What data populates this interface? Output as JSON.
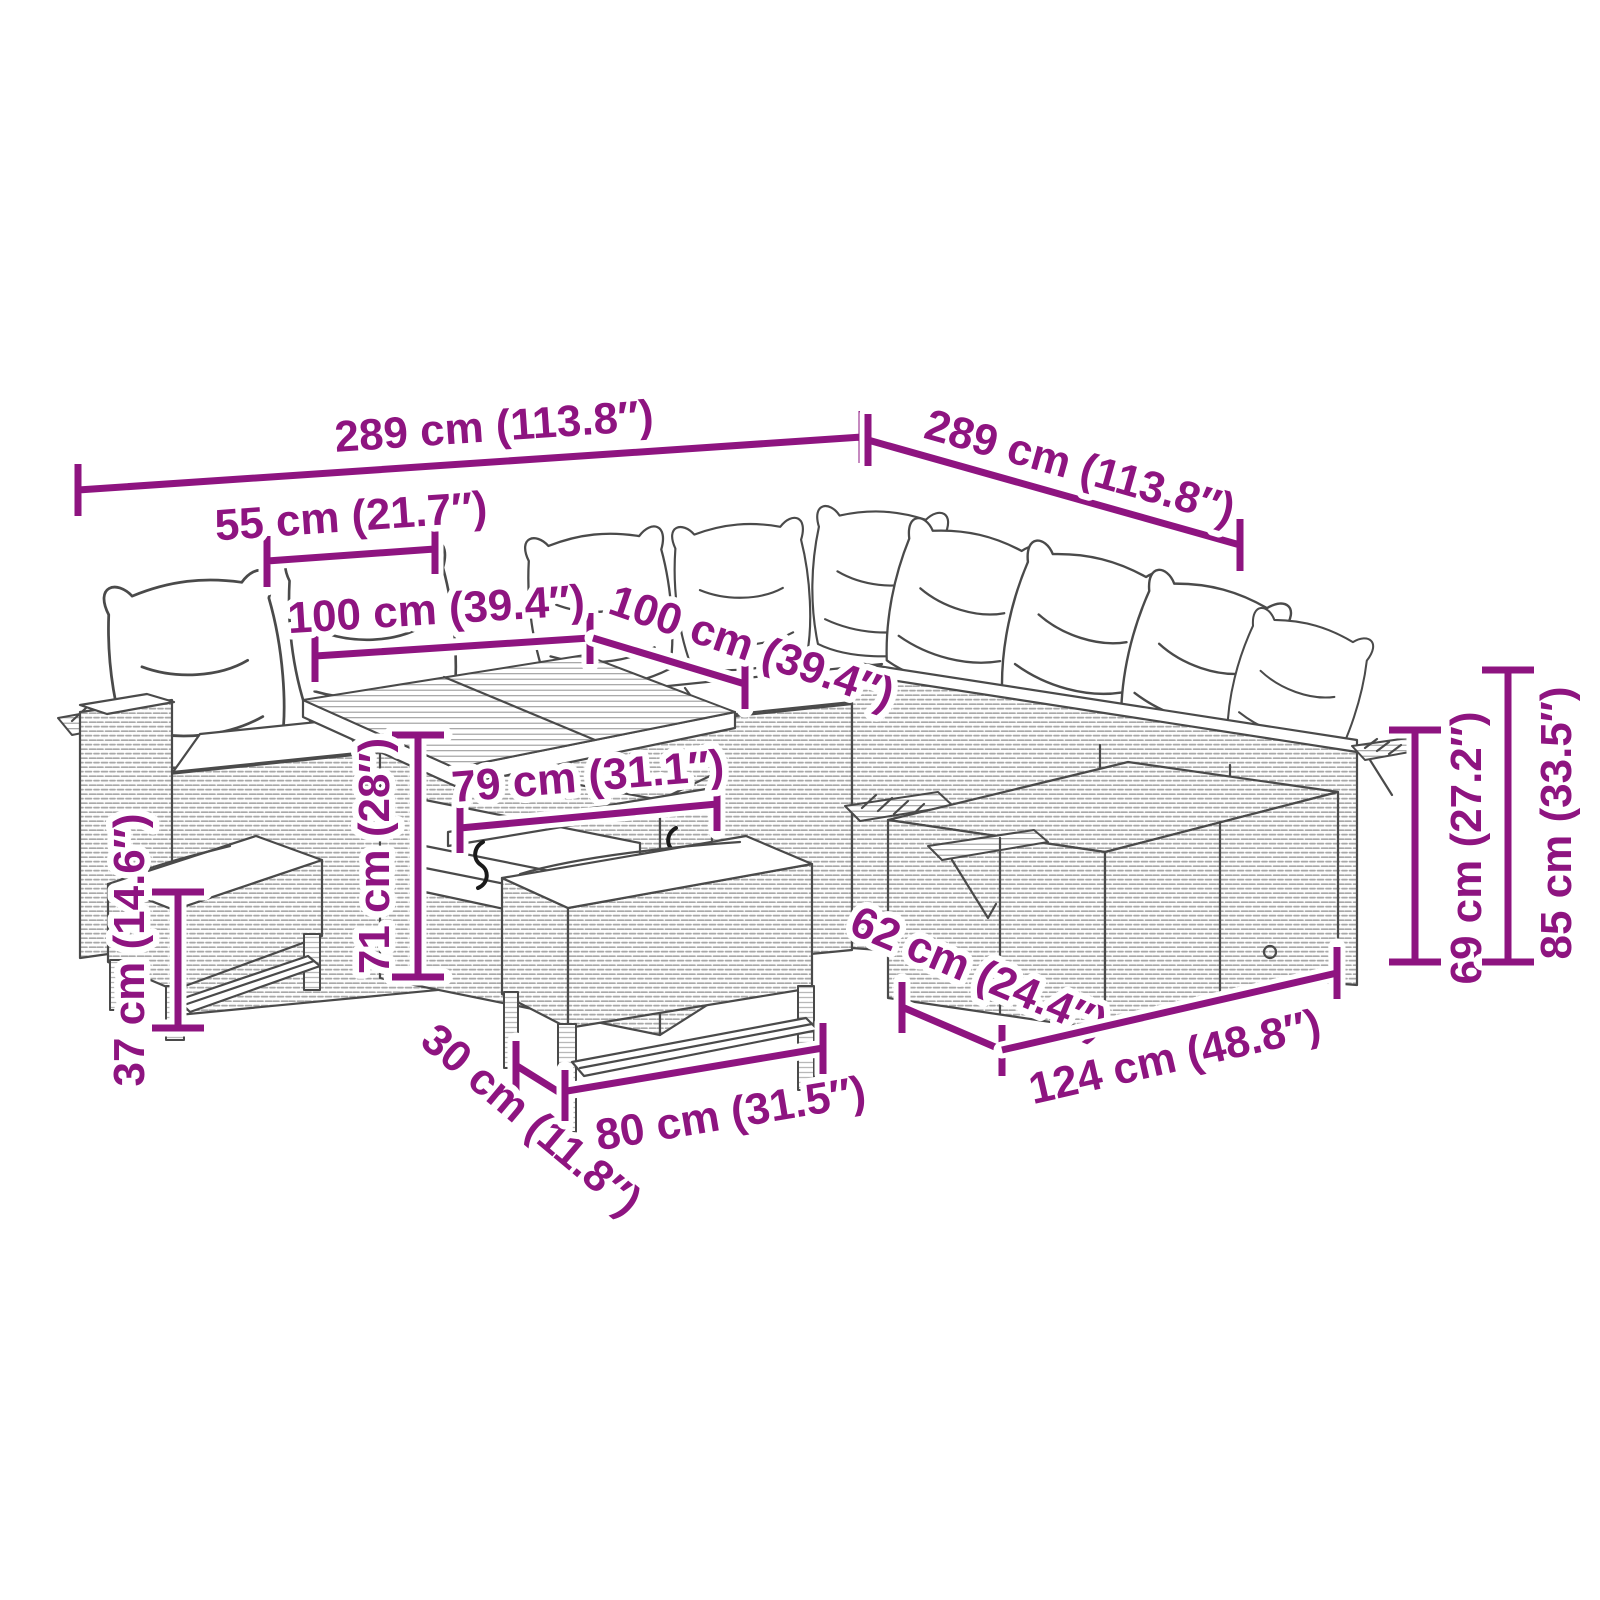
{
  "diagram": {
    "accent_color": "#8E1480",
    "sketch_color": "#4a4a4a",
    "background_color": "#ffffff",
    "dimensions": {
      "d289_left": "289 cm (113.8″)",
      "d289_right": "289 cm (113.8″)",
      "d55": "55 cm (21.7″)",
      "d100_left": "100 cm (39.4″)",
      "d100_right": "100 cm (39.4″)",
      "d79": "79 cm (31.1″)",
      "d71": "71 cm (28″)",
      "d37": "37 cm (14.6″)",
      "d30": "30 cm (11.8″)",
      "d80": "80 cm (31.5″)",
      "d62": "62 cm (24.4″)",
      "d124": "124 cm (48.8″)",
      "d69": "69 cm (27.2″)",
      "d85": "85 cm (33.5″)"
    }
  }
}
